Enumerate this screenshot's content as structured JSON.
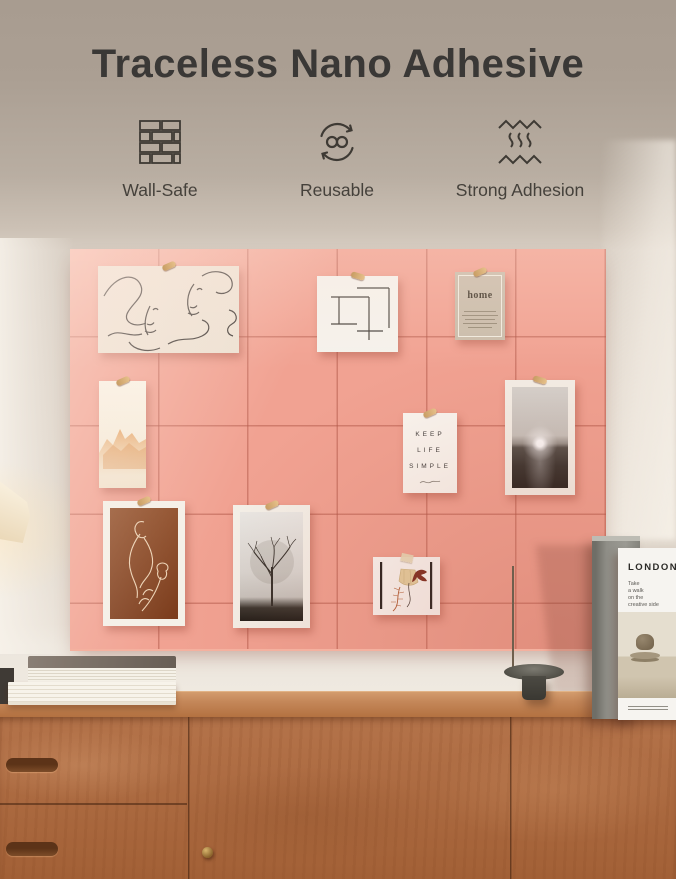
{
  "header": {
    "title": "Traceless Nano Adhesive",
    "features": [
      {
        "icon": "brick-wall-icon",
        "label": "Wall-Safe"
      },
      {
        "icon": "reuse-cycle-icon",
        "label": "Reusable"
      },
      {
        "icon": "adhesion-waves-icon",
        "label": "Strong Adhesion"
      }
    ]
  },
  "board": {
    "home_card": {
      "title": "home"
    },
    "quote_card": {
      "line1": "KEEP",
      "line2": "LIFE",
      "line3": "SIMPLE"
    }
  },
  "props": {
    "magazine": {
      "title": "LONDON",
      "subtitle_line1": "Take",
      "subtitle_line2": "a walk",
      "subtitle_line3": "on the",
      "subtitle_line4": "creative side"
    }
  },
  "colors": {
    "board_pink": "#F1A292",
    "wood_front": "#AC6A41",
    "header_top": "#A89C90",
    "wall": "#DDD3C8",
    "title_text": "#3A3836"
  }
}
